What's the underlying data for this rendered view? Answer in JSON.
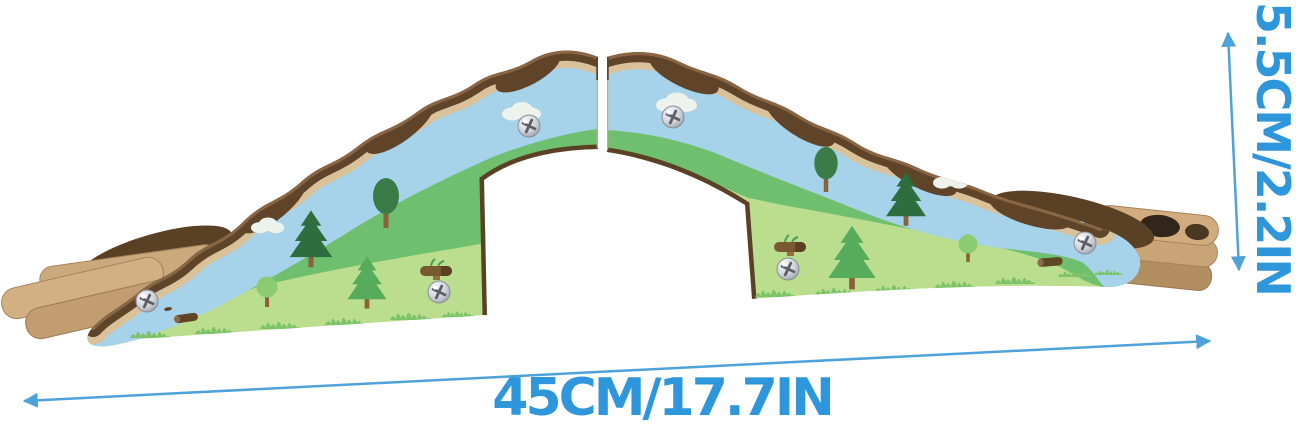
{
  "image": {
    "type": "product-photo",
    "subject": "Two-piece wooden toy train track bridge ramp, painted with a blue river, green meadows, pine and round trees, clouds, logs and silver screws; natural wood track ends visible at both sides",
    "background": "#ffffff"
  },
  "annotations": {
    "width_label": "45CM/17.7IN",
    "height_label": "5.5CM/2.2IN",
    "width_cm": 45,
    "width_in": 17.7,
    "height_cm": 5.5,
    "height_in": 2.2,
    "text_color": "#2e96da",
    "arrow_color": "#4fa2d9"
  },
  "palette": {
    "river_blue": "#a6d3ea",
    "meadow_green": "#6ec06f",
    "light_grass_green": "#bbde8e",
    "trim_brown": "#5f4429",
    "wood_tan": "#cba97d",
    "pine_dark_green": "#2e6e3e",
    "pine_light_green": "#57ac5b",
    "screw_silver": "#cfd3d9"
  },
  "icon_legend": {
    "pine-tree": "stylized three-tier conifer",
    "round-tree": "oval canopy deciduous tree",
    "small-tree": "small round canopy tree",
    "cloud": "white puffy cloud",
    "screw": "silver phillips screw head",
    "log": "fallen brown log",
    "bush": "brown log bush with green sprigs"
  }
}
